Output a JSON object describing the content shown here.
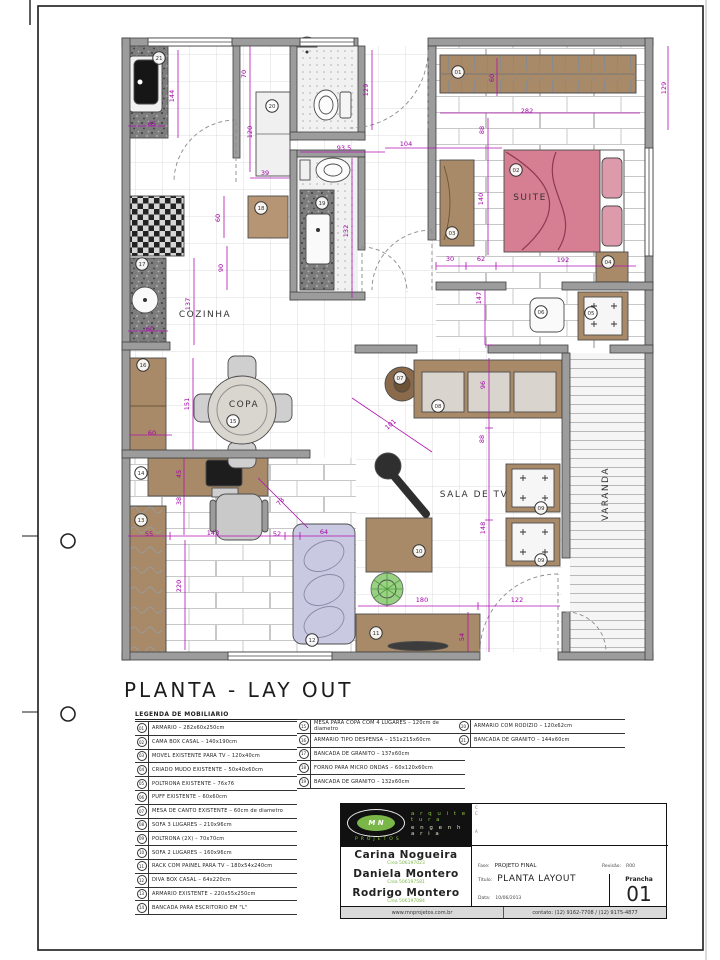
{
  "page": {
    "title": "PLANTA - LAY OUT"
  },
  "colors": {
    "dimension": "#a400a8",
    "wall": "#9c9c9c",
    "furniture": "#a98a68",
    "bed_pink": "#d67f93",
    "chaise_lavender": "#c9c9e2",
    "plant_green": "#7cc86a",
    "logo_green": "#7ab648"
  },
  "plan": {
    "rooms": [
      {
        "label": "COZINHA",
        "x": 205,
        "y": 317,
        "r": 0
      },
      {
        "label": "COPA",
        "x": 244,
        "y": 407,
        "r": 0
      },
      {
        "label": "SUITE",
        "x": 530,
        "y": 200,
        "r": 0
      },
      {
        "label": "SALA DE TV",
        "x": 474,
        "y": 497,
        "r": 0
      },
      {
        "label": "VARANDA",
        "x": 608,
        "y": 494,
        "r": -90
      }
    ],
    "dimensions": [
      {
        "v": "144",
        "x": 174,
        "y": 96,
        "r": -90
      },
      {
        "v": "65",
        "x": 152,
        "y": 126,
        "r": 0
      },
      {
        "v": "70",
        "x": 246,
        "y": 74,
        "r": -90
      },
      {
        "v": "120",
        "x": 252,
        "y": 132,
        "r": -90
      },
      {
        "v": "129",
        "x": 368,
        "y": 90,
        "r": -90
      },
      {
        "v": "129",
        "x": 666,
        "y": 88,
        "r": -90
      },
      {
        "v": "93.5",
        "x": 344,
        "y": 150,
        "r": 0
      },
      {
        "v": "104",
        "x": 406,
        "y": 146,
        "r": 0
      },
      {
        "v": "282",
        "x": 527,
        "y": 113,
        "r": 0
      },
      {
        "v": "88",
        "x": 484,
        "y": 130,
        "r": -90
      },
      {
        "v": "60",
        "x": 494,
        "y": 78,
        "r": -90
      },
      {
        "v": "140",
        "x": 483,
        "y": 199,
        "r": -90
      },
      {
        "v": "30",
        "x": 450,
        "y": 261,
        "r": 0
      },
      {
        "v": "62",
        "x": 481,
        "y": 261,
        "r": 0
      },
      {
        "v": "192",
        "x": 563,
        "y": 262,
        "r": 0
      },
      {
        "v": "39",
        "x": 265,
        "y": 175,
        "r": 0
      },
      {
        "v": "132",
        "x": 348,
        "y": 231,
        "r": -90
      },
      {
        "v": "60",
        "x": 220,
        "y": 218,
        "r": -90
      },
      {
        "v": "90",
        "x": 223,
        "y": 268,
        "r": -90
      },
      {
        "v": "137",
        "x": 190,
        "y": 304,
        "r": -90
      },
      {
        "v": "60",
        "x": 150,
        "y": 331,
        "r": 0
      },
      {
        "v": "151",
        "x": 189,
        "y": 404,
        "r": -90
      },
      {
        "v": "60",
        "x": 152,
        "y": 435,
        "r": 0
      },
      {
        "v": "101",
        "x": 392,
        "y": 426,
        "r": -42
      },
      {
        "v": "147",
        "x": 481,
        "y": 298,
        "r": -90
      },
      {
        "v": "96",
        "x": 485,
        "y": 385,
        "r": -90
      },
      {
        "v": "88",
        "x": 484,
        "y": 439,
        "r": -90
      },
      {
        "v": "148",
        "x": 485,
        "y": 528,
        "r": -90
      },
      {
        "v": "55",
        "x": 149,
        "y": 536,
        "r": 0
      },
      {
        "v": "143",
        "x": 213,
        "y": 535,
        "r": 0
      },
      {
        "v": "52",
        "x": 277,
        "y": 536,
        "r": 0
      },
      {
        "v": "64",
        "x": 324,
        "y": 534,
        "r": 0
      },
      {
        "v": "45",
        "x": 181,
        "y": 474,
        "r": -90
      },
      {
        "v": "38",
        "x": 181,
        "y": 501,
        "r": -90
      },
      {
        "v": "78",
        "x": 282,
        "y": 503,
        "r": -50
      },
      {
        "v": "220",
        "x": 181,
        "y": 586,
        "r": -90
      },
      {
        "v": "180",
        "x": 422,
        "y": 602,
        "r": 0
      },
      {
        "v": "122",
        "x": 517,
        "y": 602,
        "r": 0
      },
      {
        "v": "54",
        "x": 464,
        "y": 637,
        "r": -90
      }
    ],
    "markers": [
      {
        "n": "01",
        "x": 458,
        "y": 72
      },
      {
        "n": "02",
        "x": 516,
        "y": 170
      },
      {
        "n": "03",
        "x": 452,
        "y": 233
      },
      {
        "n": "04",
        "x": 608,
        "y": 262
      },
      {
        "n": "05",
        "x": 591,
        "y": 313
      },
      {
        "n": "06",
        "x": 541,
        "y": 312
      },
      {
        "n": "07",
        "x": 400,
        "y": 378
      },
      {
        "n": "08",
        "x": 438,
        "y": 406
      },
      {
        "n": "09",
        "x": 541,
        "y": 508
      },
      {
        "n": "09",
        "x": 541,
        "y": 560
      },
      {
        "n": "10",
        "x": 419,
        "y": 551
      },
      {
        "n": "11",
        "x": 376,
        "y": 633
      },
      {
        "n": "12",
        "x": 312,
        "y": 640
      },
      {
        "n": "13",
        "x": 141,
        "y": 520
      },
      {
        "n": "14",
        "x": 141,
        "y": 473
      },
      {
        "n": "15",
        "x": 233,
        "y": 421
      },
      {
        "n": "16",
        "x": 143,
        "y": 365
      },
      {
        "n": "17",
        "x": 142,
        "y": 264
      },
      {
        "n": "18",
        "x": 261,
        "y": 208
      },
      {
        "n": "19",
        "x": 322,
        "y": 203
      },
      {
        "n": "20",
        "x": 272,
        "y": 106
      },
      {
        "n": "21",
        "x": 159,
        "y": 58
      }
    ]
  },
  "legend": {
    "title": "LEGENDA DE MOBILIARIO",
    "columns": [
      {
        "items": [
          {
            "num": "01",
            "text": "ARMARIO – 282x60x250cm"
          },
          {
            "num": "02",
            "text": "CAMA BOX CASAL – 140x190cm"
          },
          {
            "num": "03",
            "text": "MOVEL EXISTENTE PARA TV – 120x40cm"
          },
          {
            "num": "04",
            "text": "CRIADO MUDO EXISTENTE – 50x40x60cm"
          },
          {
            "num": "05",
            "text": "POLTRONA EXISTENTE – 76x76"
          },
          {
            "num": "06",
            "text": "PUFF EXISTENTE – 60x60cm"
          },
          {
            "num": "07",
            "text": "MESA DE CANTO EXISTENTE – 60cm de diametro"
          },
          {
            "num": "08",
            "text": "SOFA 3 LUGARES – 210x96cm"
          },
          {
            "num": "09",
            "text": "POLTRONA (2X) – 70x70cm"
          },
          {
            "num": "10",
            "text": "SOFA 2 LUGARES – 160x96cm"
          },
          {
            "num": "11",
            "text": "RACK COM PAINEL PARA TV – 180x54x240cm"
          },
          {
            "num": "12",
            "text": "DIVA BOX CASAL – 64x220cm"
          },
          {
            "num": "13",
            "text": "ARMARIO EXISTENTE – 220x55x250cm"
          },
          {
            "num": "14",
            "text": "BANCADA PARA ESCRITORIO EM \"L\""
          }
        ]
      },
      {
        "items": [
          {
            "num": "15",
            "text": "MESA PARA COPA COM 4 LUGARES – 120cm de diametro"
          },
          {
            "num": "16",
            "text": "ARMARIO TIPO DESPENSA – 151x215x60cm"
          },
          {
            "num": "17",
            "text": "BANCADA DE GRANITO – 137x60cm"
          },
          {
            "num": "18",
            "text": "FORNO PARA MICRO ONDAS – 60x120x60cm"
          },
          {
            "num": "19",
            "text": "BANCADA DE GRANITO – 132x60cm"
          }
        ]
      },
      {
        "items": [
          {
            "num": "20",
            "text": "ARMARIO COM RODIZIO – 120x62cm"
          },
          {
            "num": "21",
            "text": "BANCADA DE GRANITO – 144x60cm"
          }
        ]
      }
    ]
  },
  "titleblock": {
    "logo": {
      "mark": "M N",
      "line1": "a r q u i t e t u r a",
      "line2": "e n g e n h a r i a",
      "sub": "PROJETOS"
    },
    "client_lines": [
      "C",
      "C",
      "A"
    ],
    "authors": [
      {
        "name": "Carina  Nogueira",
        "crea": "Crea 506197023"
      },
      {
        "name": "Daniela Montero",
        "crea": "Crea 506197581"
      },
      {
        "name": "Rodrigo Montero",
        "crea": "Crea 506197084"
      }
    ],
    "fields": {
      "fase_label": "Fase:",
      "fase": "PROJETO FINAL",
      "rev_label": "Revisão:",
      "rev": "R00",
      "titulo_label": "Título:",
      "titulo": "PLANTA LAYOUT",
      "data_label": "Data:",
      "data": "10/06/2013",
      "esc_label": "esc:",
      "esc": "1:50",
      "prancha_label": "Prancha",
      "prancha": "01"
    },
    "footer": {
      "site": "www.mnprojetos.com.br",
      "contato": "contato: (12) 9162-7708  /  (12) 9175-4877"
    }
  }
}
